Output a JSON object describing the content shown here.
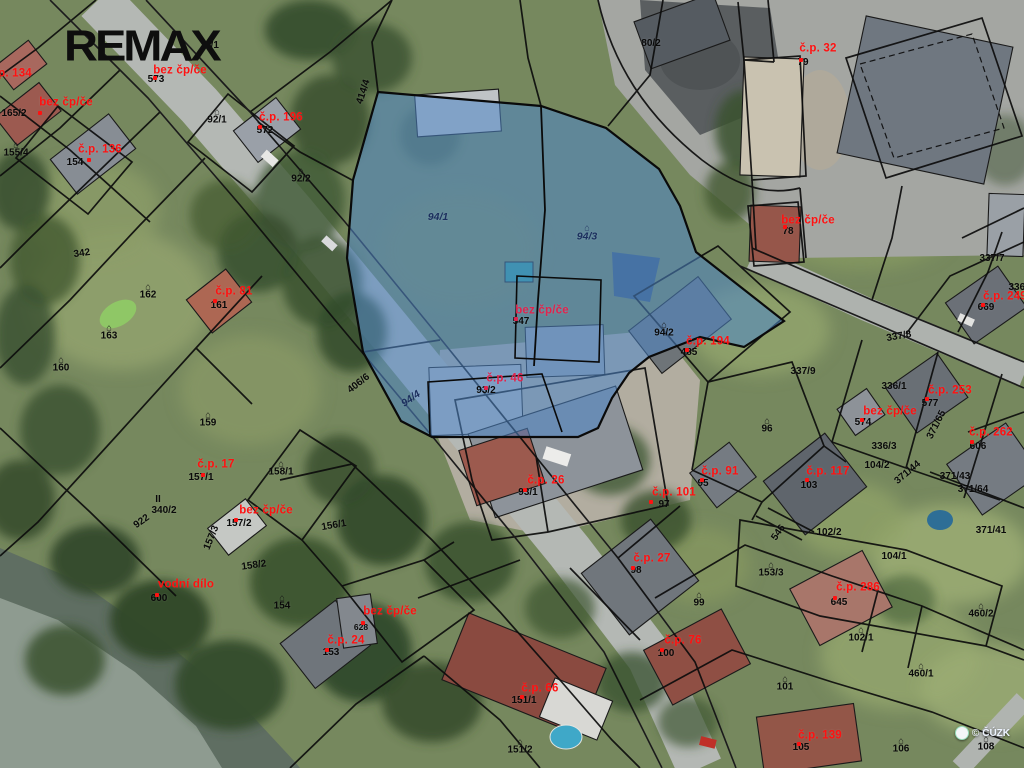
{
  "branding": {
    "logo_text": "REMAX",
    "watermark_text": "ČÚZK",
    "watermark_prefix": "©"
  },
  "map": {
    "highlight_color": "#4f86c9",
    "highlight_opacity": 0.55,
    "colors": {
      "red": "#ff1111",
      "red2": "#e0234d",
      "black": "#0a0a0a",
      "blue": "#1c2f5e"
    },
    "labels": [
      {
        "text": "č.p. 134",
        "x": 10,
        "y": 74,
        "type": "red"
      },
      {
        "text": "bez čp/če",
        "x": 66,
        "y": 103,
        "type": "red",
        "dot": [
          -28,
          8
        ]
      },
      {
        "text": "č.p. 136",
        "x": 100,
        "y": 150,
        "type": "red",
        "dot": [
          -13,
          8
        ]
      },
      {
        "text": "bez čp/če",
        "x": 180,
        "y": 71,
        "type": "red",
        "dot": [
          -27,
          5
        ]
      },
      {
        "text": "č.p. 196",
        "x": 281,
        "y": 118,
        "type": "red",
        "dot": [
          -23,
          7
        ]
      },
      {
        "text": "č.p. 81",
        "x": 234,
        "y": 292,
        "type": "red",
        "dot": [
          -21,
          7
        ]
      },
      {
        "text": "č.p. 32",
        "x": 818,
        "y": 49,
        "type": "red",
        "dot": [
          -19,
          9
        ]
      },
      {
        "text": "bez čp/če",
        "x": 808,
        "y": 221,
        "type": "red",
        "dot": [
          -25,
          4
        ]
      },
      {
        "text": "bez čp/če",
        "x": 542,
        "y": 311,
        "type": "red2",
        "dot": [
          -28,
          6
        ]
      },
      {
        "text": "č.p. 46",
        "x": 505,
        "y": 379,
        "type": "red2",
        "dot": [
          -21,
          7
        ]
      },
      {
        "text": "č.p. 26",
        "x": 546,
        "y": 481,
        "type": "red",
        "dot": [
          -23,
          7
        ]
      },
      {
        "text": "č.p. 194",
        "x": 708,
        "y": 342,
        "type": "red",
        "dot": [
          -23,
          6
        ]
      },
      {
        "text": "č.p. 249",
        "x": 1005,
        "y": 297,
        "type": "red",
        "dot": [
          -24,
          6
        ]
      },
      {
        "text": "č.p. 253",
        "x": 950,
        "y": 391,
        "type": "red",
        "dot": [
          -25,
          6
        ]
      },
      {
        "text": "bez čp/če",
        "x": 890,
        "y": 412,
        "type": "red",
        "dot": [
          -30,
          6
        ]
      },
      {
        "text": "č.p. 262",
        "x": 991,
        "y": 433,
        "type": "red",
        "dot": [
          -21,
          7
        ]
      },
      {
        "text": "č.p. 117",
        "x": 828,
        "y": 472,
        "type": "red",
        "dot": [
          -23,
          6
        ]
      },
      {
        "text": "č.p. 91",
        "x": 720,
        "y": 472,
        "type": "red",
        "dot": [
          -20,
          6
        ]
      },
      {
        "text": "č.p. 101",
        "x": 674,
        "y": 493,
        "type": "red",
        "dot": [
          -25,
          7
        ]
      },
      {
        "text": "č.p. 27",
        "x": 652,
        "y": 559,
        "type": "red",
        "dot": [
          -21,
          7
        ]
      },
      {
        "text": "č.p. 286",
        "x": 858,
        "y": 588,
        "type": "red",
        "dot": [
          -25,
          8
        ]
      },
      {
        "text": "č.p. 76",
        "x": 683,
        "y": 641,
        "type": "red",
        "dot": [
          -23,
          7
        ]
      },
      {
        "text": "č.p. 139",
        "x": 820,
        "y": 736,
        "type": "red",
        "dot": [
          -23,
          6
        ]
      },
      {
        "text": "č.p. 66",
        "x": 540,
        "y": 689,
        "type": "red",
        "dot": [
          -20,
          6
        ]
      },
      {
        "text": "bez čp/če",
        "x": 390,
        "y": 612,
        "type": "red",
        "dot": [
          -29,
          9
        ]
      },
      {
        "text": "č.p. 24",
        "x": 346,
        "y": 641,
        "type": "red",
        "dot": [
          -21,
          7
        ]
      },
      {
        "text": "vodní dílo",
        "x": 186,
        "y": 585,
        "type": "red",
        "dot": [
          -31,
          8
        ]
      },
      {
        "text": "č.p. 17",
        "x": 216,
        "y": 465,
        "type": "red",
        "dot": [
          -15,
          8
        ]
      },
      {
        "text": "bez čp/če",
        "x": 266,
        "y": 511,
        "type": "red",
        "dot": [
          -32,
          7
        ]
      },
      {
        "text": "165/2",
        "x": 14,
        "y": 114
      },
      {
        "text": "155/4",
        "x": 16,
        "y": 150,
        "icon": 1
      },
      {
        "text": "154",
        "x": 75,
        "y": 163
      },
      {
        "text": "573",
        "x": 156,
        "y": 80
      },
      {
        "text": "572",
        "x": 265,
        "y": 131
      },
      {
        "text": "92/1",
        "x": 217,
        "y": 117,
        "icon": 1
      },
      {
        "text": "92/2",
        "x": 301,
        "y": 176,
        "icon": 1
      },
      {
        "text": "4/1",
        "x": 212,
        "y": 46
      },
      {
        "text": "80/2",
        "x": 651,
        "y": 44
      },
      {
        "text": "79",
        "x": 803,
        "y": 63
      },
      {
        "text": "78",
        "x": 788,
        "y": 232
      },
      {
        "text": "342",
        "x": 82,
        "y": 254,
        "rot": -8
      },
      {
        "text": "162",
        "x": 148,
        "y": 292,
        "icon": 1
      },
      {
        "text": "163",
        "x": 109,
        "y": 333,
        "icon": 1
      },
      {
        "text": "160",
        "x": 61,
        "y": 365,
        "icon": 1
      },
      {
        "text": "161",
        "x": 219,
        "y": 306
      },
      {
        "text": "159",
        "x": 208,
        "y": 420,
        "icon": 1
      },
      {
        "text": "158/1",
        "x": 281,
        "y": 469,
        "icon": 1
      },
      {
        "text": "157/1",
        "x": 201,
        "y": 478
      },
      {
        "text": "340/2",
        "x": 164,
        "y": 511
      },
      {
        "text": "II",
        "x": 158,
        "y": 500
      },
      {
        "text": "922",
        "x": 142,
        "y": 522,
        "rot": -35
      },
      {
        "text": "157/2",
        "x": 239,
        "y": 524
      },
      {
        "text": "157/3",
        "x": 212,
        "y": 538,
        "rot": -68
      },
      {
        "text": "158/2",
        "x": 254,
        "y": 566,
        "rot": -8
      },
      {
        "text": "156/1",
        "x": 334,
        "y": 526,
        "rot": -10
      },
      {
        "text": "154",
        "x": 282,
        "y": 603,
        "icon": 1
      },
      {
        "text": "153",
        "x": 331,
        "y": 653
      },
      {
        "text": "600",
        "x": 159,
        "y": 599
      },
      {
        "text": "628",
        "x": 361,
        "y": 627,
        "small": 1
      },
      {
        "text": "151/1",
        "x": 524,
        "y": 701
      },
      {
        "text": "151/2",
        "x": 520,
        "y": 747,
        "icon": 1
      },
      {
        "text": "406/6",
        "x": 359,
        "y": 384,
        "rot": -38
      },
      {
        "text": "93/2",
        "x": 486,
        "y": 391
      },
      {
        "text": "93/1",
        "x": 528,
        "y": 493
      },
      {
        "text": "547",
        "x": 521,
        "y": 322
      },
      {
        "text": "485",
        "x": 689,
        "y": 353
      },
      {
        "text": "94/2",
        "x": 664,
        "y": 330,
        "icon": 1
      },
      {
        "text": "96",
        "x": 767,
        "y": 426,
        "icon": 1
      },
      {
        "text": "337/8",
        "x": 899,
        "y": 337,
        "rot": -10
      },
      {
        "text": "337/9",
        "x": 803,
        "y": 372
      },
      {
        "text": "336/1",
        "x": 894,
        "y": 387
      },
      {
        "text": "337/7",
        "x": 992,
        "y": 259
      },
      {
        "text": "336/8",
        "x": 1021,
        "y": 288
      },
      {
        "text": "371/41",
        "x": 991,
        "y": 531
      },
      {
        "text": "371/65",
        "x": 937,
        "y": 425,
        "rot": -63
      },
      {
        "text": "371/43",
        "x": 955,
        "y": 477
      },
      {
        "text": "371/64",
        "x": 973,
        "y": 490
      },
      {
        "text": "371/44",
        "x": 908,
        "y": 473,
        "rot": -40
      },
      {
        "text": "669",
        "x": 986,
        "y": 308
      },
      {
        "text": "577",
        "x": 930,
        "y": 404
      },
      {
        "text": "574",
        "x": 863,
        "y": 423
      },
      {
        "text": "606",
        "x": 978,
        "y": 447
      },
      {
        "text": "336/3",
        "x": 884,
        "y": 447
      },
      {
        "text": "104/2",
        "x": 877,
        "y": 466
      },
      {
        "text": "103",
        "x": 809,
        "y": 486
      },
      {
        "text": "95",
        "x": 703,
        "y": 484
      },
      {
        "text": "97",
        "x": 664,
        "y": 505
      },
      {
        "text": "98",
        "x": 636,
        "y": 571
      },
      {
        "text": "546",
        "x": 779,
        "y": 533,
        "rot": -55
      },
      {
        "text": "102/2",
        "x": 829,
        "y": 533
      },
      {
        "text": "104/1",
        "x": 894,
        "y": 557
      },
      {
        "text": "153/3",
        "x": 771,
        "y": 570,
        "icon": 1
      },
      {
        "text": "99",
        "x": 699,
        "y": 600,
        "icon": 1
      },
      {
        "text": "102/1",
        "x": 861,
        "y": 635,
        "icon": 1
      },
      {
        "text": "460/2",
        "x": 981,
        "y": 611,
        "icon": 1
      },
      {
        "text": "101",
        "x": 785,
        "y": 684,
        "icon": 1
      },
      {
        "text": "460/1",
        "x": 921,
        "y": 671,
        "icon": 1
      },
      {
        "text": "645",
        "x": 839,
        "y": 603
      },
      {
        "text": "100",
        "x": 666,
        "y": 654
      },
      {
        "text": "105",
        "x": 801,
        "y": 748
      },
      {
        "text": "106",
        "x": 901,
        "y": 746,
        "icon": 1
      },
      {
        "text": "108",
        "x": 986,
        "y": 744,
        "icon": 1
      },
      {
        "text": "414/4",
        "x": 364,
        "y": 92,
        "rot": -72
      },
      {
        "text": "94/1",
        "x": 438,
        "y": 217,
        "type": "blue"
      },
      {
        "text": "94/3",
        "x": 587,
        "y": 233,
        "type": "blue",
        "icon": 1
      },
      {
        "text": "94/4",
        "x": 411,
        "y": 399,
        "rot": -35,
        "type": "blue"
      }
    ]
  }
}
